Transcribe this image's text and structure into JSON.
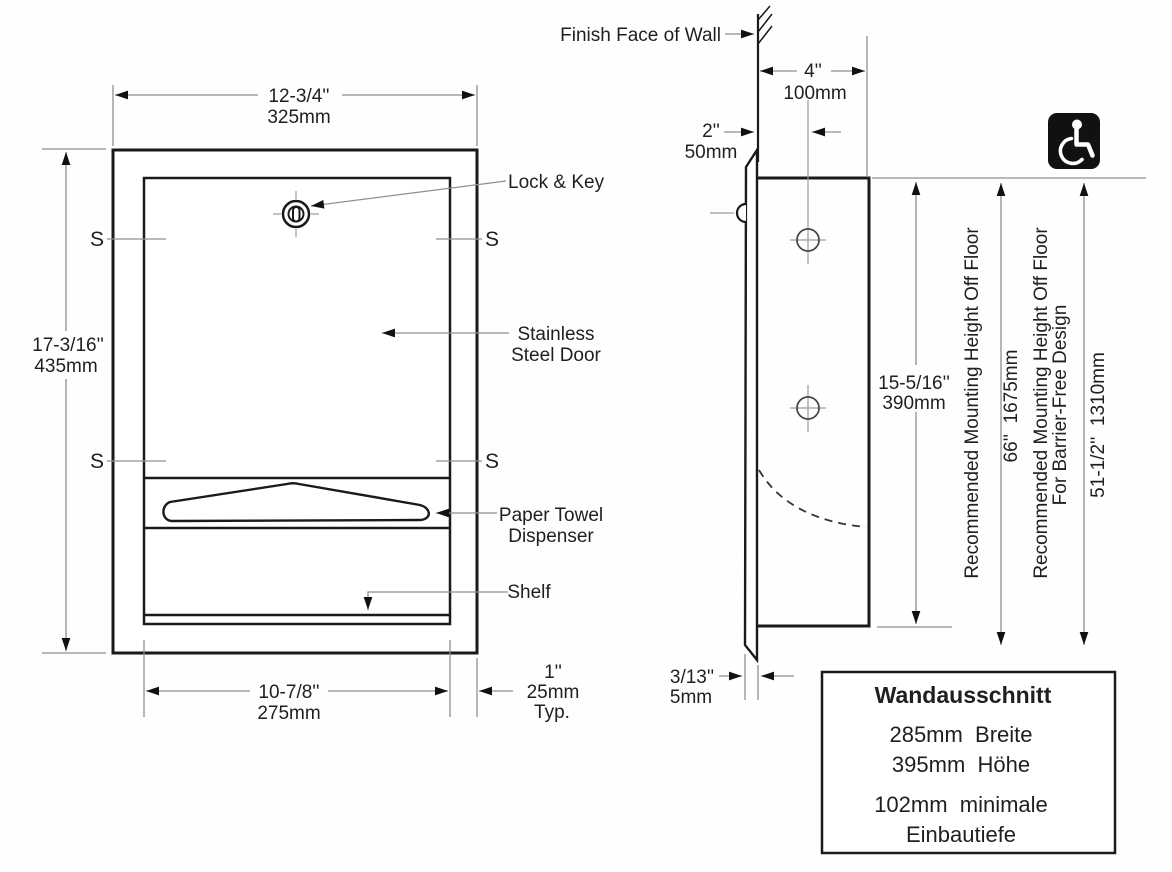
{
  "front": {
    "dim_top": {
      "in": "12-3/4''",
      "mm": "325mm"
    },
    "dim_left": {
      "in": "17-3/16''",
      "mm": "435mm"
    },
    "dim_bottom": {
      "in": "10-7/8''",
      "mm": "275mm"
    },
    "dim_trim": {
      "in": "1''",
      "mm": "25mm",
      "typ": "Typ."
    },
    "s_marker": "S",
    "labels": {
      "lock_key": "Lock & Key",
      "door1": "Stainless",
      "door2": "Steel Door",
      "dispenser1": "Paper Towel",
      "dispenser2": "Dispenser",
      "shelf": "Shelf"
    }
  },
  "side": {
    "wall": "Finish Face of Wall",
    "dim_depth": {
      "in": "4''",
      "mm": "100mm"
    },
    "dim_offset": {
      "in": "2''",
      "mm": "50mm"
    },
    "dim_height": {
      "in": "15-5/16''",
      "mm": "390mm"
    },
    "dim_thickness": {
      "in": "3/13''",
      "mm": "5mm"
    },
    "mount_std_label": "Recommended Mounting Height Off Floor",
    "mount_std_value": "66''  1675mm",
    "mount_bf_label1": "Recommended Mounting Height Off Floor",
    "mount_bf_label2": "For Barrier-Free Design",
    "mount_bf_value": "51-1/2''  1310mm"
  },
  "cutout": {
    "title": "Wandausschnitt",
    "width": "285mm  Breite",
    "height": "395mm  Höhe",
    "depth1": "102mm  minimale",
    "depth2": "Einbautiefe"
  },
  "icons": {
    "accessibility": "wheelchair-accessibility-symbol"
  },
  "colors": {
    "object_line": "#1a1a1a",
    "dim_line": "#8f8f8f",
    "text": "#1f1f1f",
    "icon_bg": "#111111"
  }
}
